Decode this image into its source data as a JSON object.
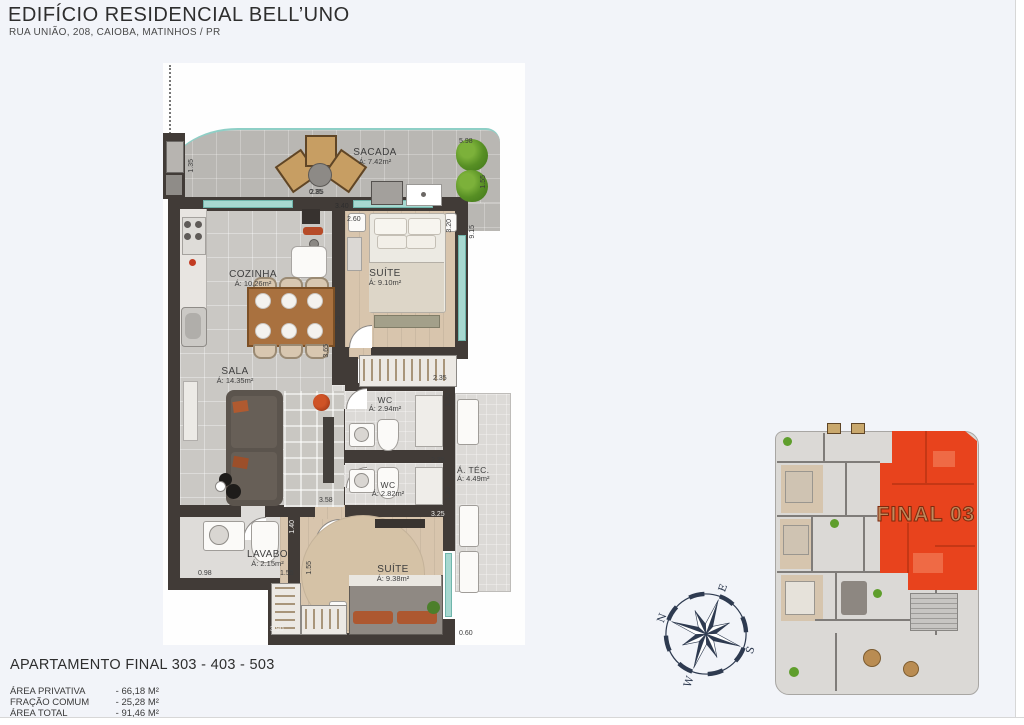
{
  "header": {
    "title": "EDIFÍCIO RESIDENCIAL BELL’UNO",
    "subtitle": "RUA UNIÃO, 208, CAIOBA, MATINHOS / PR"
  },
  "plan": {
    "rooms": [
      {
        "name": "SACADA",
        "area": "Á: 7.42m²"
      },
      {
        "name": "COZINHA",
        "area": "Á: 10.26m²"
      },
      {
        "name": "SUÍTE",
        "area": "Á: 9.10m²"
      },
      {
        "name": "SALA",
        "area": "Á: 14.35m²"
      },
      {
        "name": "WC",
        "area": "Á: 2.94m²"
      },
      {
        "name": "WC",
        "area": "Á: 2.82m²"
      },
      {
        "name": "Á. TÉC.",
        "area": "Á: 4.49m²"
      },
      {
        "name": "LAVABO",
        "area": "Á: 2.15m²"
      },
      {
        "name": "SUÍTE",
        "area": "Á: 9.38m²"
      }
    ],
    "dims": [
      "5.98",
      "1.35",
      "2.85",
      "1.55",
      "3.40",
      "0.35",
      "2.60",
      "3.20",
      "9.15",
      "2.55",
      "3.65",
      "2.35",
      "1.20",
      "2.35",
      "1.20",
      "3.25",
      "3.58",
      "1.40",
      "0.98",
      "1.55",
      "1.55",
      "3.90",
      "0.60"
    ]
  },
  "keyplan": {
    "label": "FINAL 03",
    "highlight_color": "#e8431d"
  },
  "compass": {
    "n": "N",
    "e": "E",
    "s": "S",
    "w": "W"
  },
  "footer": {
    "apartment": "APARTAMENTO FINAL 303 - 403 - 503",
    "areas": [
      {
        "label": "ÁREA PRIVATIVA",
        "value": "- 66,18 M²"
      },
      {
        "label": "FRAÇÃO COMUM",
        "value": "- 25,28 M²"
      },
      {
        "label": "ÁREA TOTAL",
        "value": "- 91,46 M²"
      }
    ]
  }
}
